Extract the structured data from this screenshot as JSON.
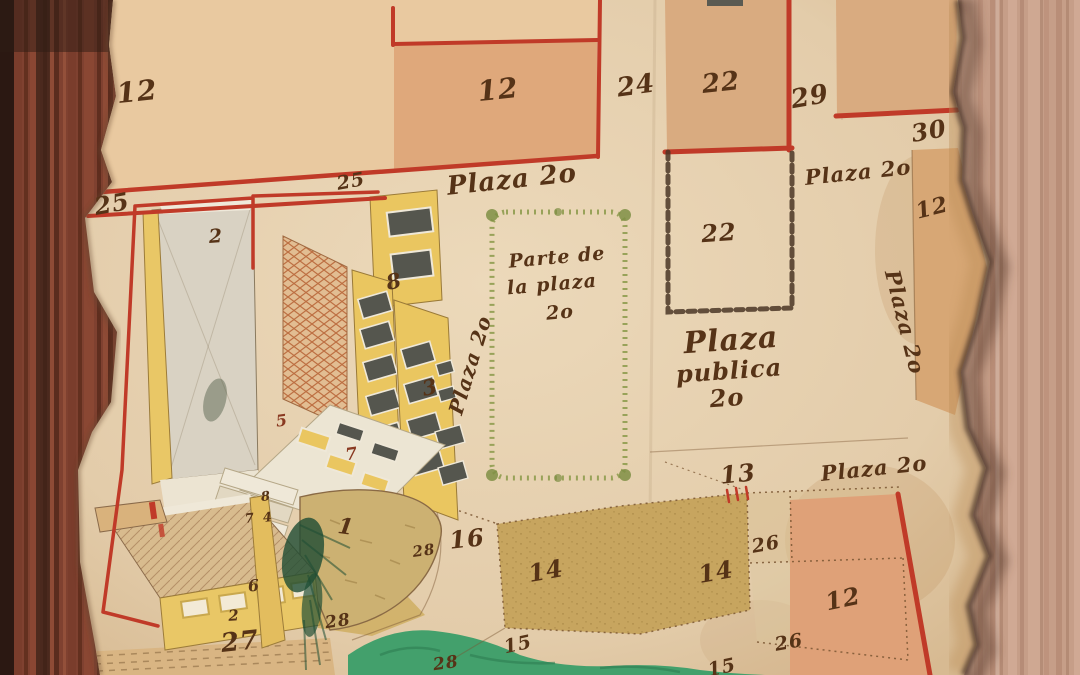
{
  "palette": {
    "ink": "#563317",
    "ink_red": "#8a3a22",
    "red_line": "#c03a28",
    "parchment": "#e6cfae",
    "parchment_edge": "#caa06c",
    "plot_peach": "#e9c9a0",
    "plot_salmon": "#dfa87b",
    "plot_tan": "#d9ab80",
    "plot_khaki": "#c7a55f",
    "pond_green": "#43a06c",
    "hedge_green": "#8f9c4f",
    "wall_yellow": "#eac660",
    "brick_orange": "#c0713f",
    "window_gray": "#55564e",
    "chain_brown": "#4a3626",
    "wood_left": "#82422e",
    "wood_right": "#c9a28c"
  },
  "labels": [
    {
      "name": "plot-number-12-topleft",
      "text": "12",
      "x": 137,
      "y": 92,
      "size": 28,
      "rot": -6
    },
    {
      "name": "plot-number-12-topcenter",
      "text": "12",
      "x": 498,
      "y": 90,
      "size": 28,
      "rot": -6
    },
    {
      "name": "plot-number-24",
      "text": "24",
      "x": 636,
      "y": 86,
      "size": 26,
      "rot": -8
    },
    {
      "name": "plot-number-22-top",
      "text": "22",
      "x": 721,
      "y": 83,
      "size": 26,
      "rot": -6
    },
    {
      "name": "plot-number-29",
      "text": "29",
      "x": 810,
      "y": 97,
      "size": 26,
      "rot": -10
    },
    {
      "name": "plot-number-30",
      "text": "30",
      "x": 929,
      "y": 131,
      "size": 24,
      "rot": -10
    },
    {
      "name": "street-label-plaza-20-topright",
      "text": "Plaza 2o",
      "x": 858,
      "y": 172,
      "size": 21,
      "rot": -6
    },
    {
      "name": "plot-number-12-rightstrip",
      "text": "12",
      "x": 932,
      "y": 208,
      "size": 22,
      "rot": -14
    },
    {
      "name": "street-label-plaza-20-right-vertical",
      "text": "Plaza 2o",
      "x": 905,
      "y": 322,
      "size": 21,
      "rot": 76
    },
    {
      "name": "street-number-25-left",
      "text": "25",
      "x": 112,
      "y": 204,
      "size": 24,
      "rot": -10
    },
    {
      "name": "street-number-25-center",
      "text": "25",
      "x": 351,
      "y": 182,
      "size": 19,
      "rot": -10
    },
    {
      "name": "street-label-plaza-20-top",
      "text": "Plaza 2o",
      "x": 512,
      "y": 180,
      "size": 26,
      "rot": -6
    },
    {
      "name": "street-label-plaza-20-left-vertical",
      "text": "Plaza 2o",
      "x": 470,
      "y": 365,
      "size": 20,
      "rot": -73
    },
    {
      "name": "plaza-note-line1",
      "text": "Parte de",
      "x": 557,
      "y": 258,
      "size": 19,
      "rot": -5
    },
    {
      "name": "plaza-note-line2",
      "text": "la plaza",
      "x": 552,
      "y": 285,
      "size": 19,
      "rot": -5
    },
    {
      "name": "plaza-note-line3",
      "text": "2o",
      "x": 560,
      "y": 313,
      "size": 19,
      "rot": -5
    },
    {
      "name": "plot-number-22-chained",
      "text": "22",
      "x": 719,
      "y": 233,
      "size": 24,
      "rot": -4
    },
    {
      "name": "plaza-publica-line1",
      "text": "Plaza",
      "x": 731,
      "y": 341,
      "size": 30,
      "rot": -4
    },
    {
      "name": "plaza-publica-line2",
      "text": "publica",
      "x": 729,
      "y": 371,
      "size": 24,
      "rot": -4
    },
    {
      "name": "plaza-publica-line3",
      "text": "2o",
      "x": 727,
      "y": 398,
      "size": 24,
      "rot": -4
    },
    {
      "name": "plot-number-13",
      "text": "13",
      "x": 738,
      "y": 474,
      "size": 24,
      "rot": -6
    },
    {
      "name": "street-label-plaza-20-bottomright",
      "text": "Plaza 2o",
      "x": 874,
      "y": 468,
      "size": 21,
      "rot": -6
    },
    {
      "name": "plot-number-16",
      "text": "16",
      "x": 467,
      "y": 539,
      "size": 24,
      "rot": -6
    },
    {
      "name": "plot-number-14-left",
      "text": "14",
      "x": 546,
      "y": 571,
      "size": 24,
      "rot": -10
    },
    {
      "name": "plot-number-14-right",
      "text": "14",
      "x": 716,
      "y": 572,
      "size": 24,
      "rot": -10
    },
    {
      "name": "plot-number-26-upper",
      "text": "26",
      "x": 766,
      "y": 545,
      "size": 19,
      "rot": -10
    },
    {
      "name": "plot-number-26-lower",
      "text": "26",
      "x": 789,
      "y": 643,
      "size": 19,
      "rot": -10
    },
    {
      "name": "plot-number-15-left",
      "text": "15",
      "x": 518,
      "y": 645,
      "size": 19,
      "rot": -12
    },
    {
      "name": "plot-number-15-right",
      "text": "15",
      "x": 722,
      "y": 668,
      "size": 19,
      "rot": -12
    },
    {
      "name": "plot-number-12-bottomright",
      "text": "12",
      "x": 843,
      "y": 599,
      "size": 24,
      "rot": -12
    },
    {
      "name": "plot-number-28-upper",
      "text": "28",
      "x": 424,
      "y": 551,
      "size": 15,
      "rot": -8
    },
    {
      "name": "plot-number-28-left",
      "text": "28",
      "x": 338,
      "y": 622,
      "size": 17,
      "rot": -8
    },
    {
      "name": "plot-number-28-right",
      "text": "28",
      "x": 446,
      "y": 664,
      "size": 17,
      "rot": -8
    },
    {
      "name": "plot-number-27",
      "text": "27",
      "x": 240,
      "y": 642,
      "size": 26,
      "rot": -6
    },
    {
      "name": "building-number-2-lower",
      "text": "2",
      "x": 234,
      "y": 616,
      "size": 15,
      "rot": -4
    },
    {
      "name": "building-number-1-bastion",
      "text": "1",
      "x": 346,
      "y": 527,
      "size": 22,
      "rot": 8
    },
    {
      "name": "courtyard-number-2",
      "text": "2",
      "x": 216,
      "y": 237,
      "size": 19,
      "rot": -4
    },
    {
      "name": "building-number-8-upper",
      "text": "8",
      "x": 394,
      "y": 281,
      "size": 21,
      "rot": -12
    },
    {
      "name": "building-number-3",
      "text": "3",
      "x": 430,
      "y": 387,
      "size": 21,
      "rot": -12
    },
    {
      "name": "building-number-5",
      "text": "5",
      "x": 282,
      "y": 421,
      "size": 16,
      "rot": -8,
      "color": "#8a3a22"
    },
    {
      "name": "building-number-7-roof",
      "text": "7",
      "x": 352,
      "y": 455,
      "size": 17,
      "rot": -8,
      "color": "#8a3a22"
    },
    {
      "name": "building-number-8-steps",
      "text": "8",
      "x": 266,
      "y": 497,
      "size": 13,
      "rot": -6
    },
    {
      "name": "building-number-7-steps",
      "text": "7",
      "x": 250,
      "y": 519,
      "size": 13,
      "rot": -6
    },
    {
      "name": "building-number-4-steps",
      "text": "4",
      "x": 268,
      "y": 518,
      "size": 13,
      "rot": -6
    },
    {
      "name": "building-number-6",
      "text": "6",
      "x": 254,
      "y": 586,
      "size": 16,
      "rot": -6
    }
  ]
}
